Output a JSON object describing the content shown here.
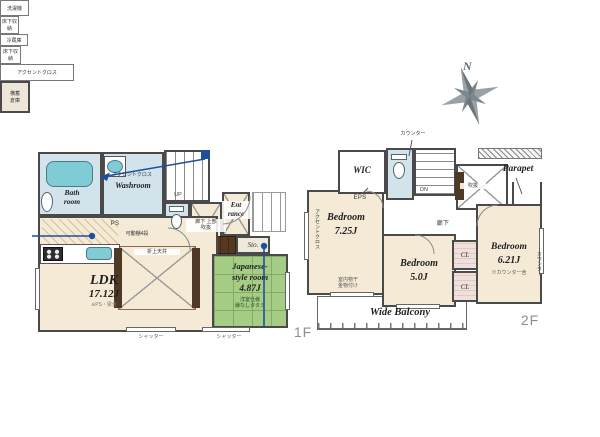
{
  "palette": {
    "wall": "#4a4a4a",
    "floor_cream": "#f4ead6",
    "water_blue": "#d3e3eb",
    "fixture_cyan": "#7fccd6",
    "tatami_green": "#a6cd86",
    "wood_brown": "#54381f",
    "marker_blue": "#1d4f9c",
    "compass_gray": "#98a1a6"
  },
  "compass": {
    "north": "N"
  },
  "f1": {
    "floor_label": "1F",
    "bath": {
      "name": "Bath\nroom"
    },
    "washroom": {
      "name": "Washroom",
      "accent": "アクセントクロス",
      "washer": "洗濯機",
      "underfloor": "床下収納"
    },
    "stairs": {
      "up": "UP"
    },
    "sto1": {
      "label": "Sto."
    },
    "hall": {
      "label": "廊下 上部\n吹抜"
    },
    "entrance": {
      "name": "Ent\nrance"
    },
    "sto2": {
      "label": "Sto."
    },
    "kitchen": {
      "fridge": "冷蔵庫",
      "underfloor": "床下収納",
      "ps": "PS",
      "shelves": "可動棚4段"
    },
    "ldk": {
      "name": "LDK",
      "size": "17.12J",
      "note": "※PS・梁含",
      "ceiling": "折上天井",
      "accent": "アクセントクロス",
      "shutter": "シャッター"
    },
    "jroom": {
      "name": "Japanese-\nstyle room",
      "size": "4.87J",
      "note": "洋室仕様\n縁なしタタミ"
    }
  },
  "f2": {
    "floor_label": "2F",
    "wic": {
      "name": "WIC"
    },
    "counter": "カウンター",
    "eps": "EPS",
    "stairs": {
      "down": "DN"
    },
    "void": {
      "label": "吹抜"
    },
    "parapet": {
      "label": "Parapet"
    },
    "hall": {
      "label": "廊下"
    },
    "closet": {
      "label": "横蓄\n倉庫"
    },
    "bed1": {
      "name": "Bedroom",
      "size": "7.25J",
      "accent": "アクセントクロス",
      "drying": "室内物干\n金物付け"
    },
    "bed2": {
      "name": "Bedroom",
      "size": "5.0J"
    },
    "cl1": {
      "label": "CL"
    },
    "cl2": {
      "label": "CL"
    },
    "bed3": {
      "name": "Bedroom",
      "size": "6.21J",
      "note": "※カウンター含",
      "counter_side": "カウンター"
    },
    "balcony": {
      "name": "Wide Balcony"
    }
  }
}
